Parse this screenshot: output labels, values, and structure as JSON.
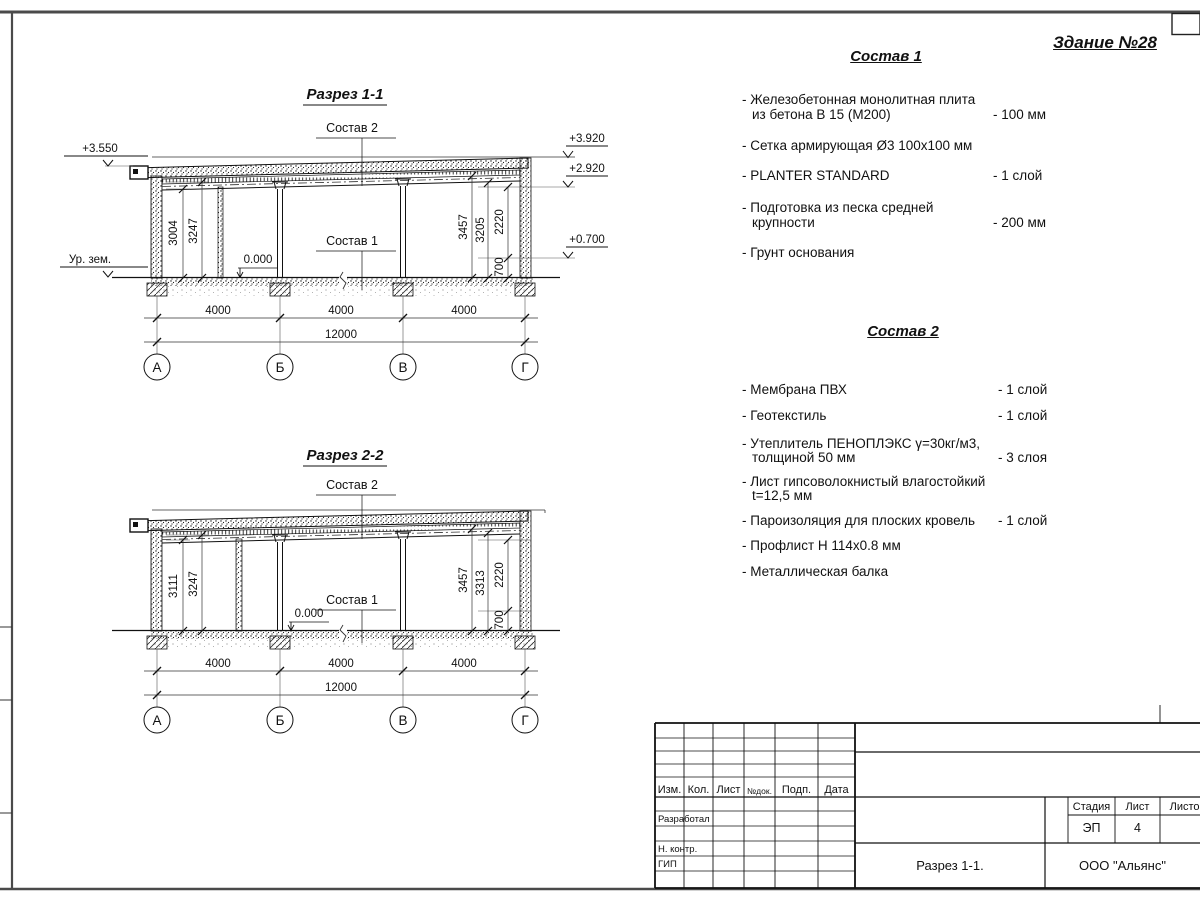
{
  "sheet": {
    "building_title": "Здание №28"
  },
  "grid": {
    "letters": [
      "А",
      "Б",
      "В",
      "Г"
    ]
  },
  "dims": {
    "span": "4000",
    "total": "12000"
  },
  "sec1": {
    "title": "Разрез 1-1",
    "roof_label": "Состав 2",
    "floor_label": "Состав 1",
    "zero": "0.000",
    "elev_left": "+3.550",
    "ground": "Ур. зем.",
    "elev_r1": "+3.920",
    "elev_r2": "+2.920",
    "elev_r3": "+0.700",
    "dl1": "3004",
    "dl2": "3247",
    "dr1": "3457",
    "dr2": "3205",
    "dr3": "2220",
    "dr4": "700"
  },
  "sec2": {
    "title": "Разрез 2-2",
    "roof_label": "Состав 2",
    "floor_label": "Состав 1",
    "zero": "0.000",
    "dl1": "3111",
    "dl2": "3247",
    "dr1": "3457",
    "dr2": "3313",
    "dr3": "2220",
    "dr4": "700"
  },
  "comp1": {
    "title": "Состав 1",
    "items": [
      {
        "l1": "- Железобетонная  монолитная плита",
        "l2": "из бетона В 15 (М200)",
        "value": "- 100 мм"
      },
      {
        "l1": "- Сетка армирующая Ø3 100х100 мм",
        "l2": "",
        "value": ""
      },
      {
        "l1": "- PLANTER STANDARD",
        "l2": "",
        "value": "- 1  слой"
      },
      {
        "l1": "- Подготовка из песка средней",
        "l2": "крупности",
        "value": "- 200 мм"
      },
      {
        "l1": "- Грунт основания",
        "l2": "",
        "value": ""
      }
    ]
  },
  "comp2": {
    "title": "Состав 2",
    "items": [
      {
        "l1": "- Мембрана ПВХ",
        "l2": "",
        "value": "- 1 слой"
      },
      {
        "l1": "- Геотекстиль",
        "l2": "",
        "value": "- 1 слой"
      },
      {
        "l1": "- Утеплитель ПЕНОПЛЭКС γ=30кг/м3,",
        "l2": "толщиной 50 мм",
        "value": "- 3 слоя"
      },
      {
        "l1": "- Лист гипсоволокнистый влагостойкий",
        "l2": "t=12,5 мм",
        "value": ""
      },
      {
        "l1": "- Пароизоляция для плоских кровель",
        "l2": "",
        "value": "- 1 слой"
      },
      {
        "l1": "- Профлист Н 114х0.8 мм",
        "l2": "",
        "value": ""
      },
      {
        "l1": "- Металлическая балка",
        "l2": "",
        "value": ""
      }
    ]
  },
  "tb": {
    "col_izm": "Изм.",
    "col_kol": "Кол.",
    "col_list": "Лист",
    "col_ndok": "№док.",
    "col_podp": "Подп.",
    "col_data": "Дата",
    "row_dev": "Разработал",
    "row_ncontr": "Н. контр.",
    "row_gip": "ГИП",
    "stage_label": "Стадия",
    "sheet_label": "Лист",
    "sheets_label": "Листов",
    "stage_value": "ЭП",
    "sheet_value": "4",
    "doc_name": "Разрез 1-1.",
    "company": "ООО \"Альянс\""
  }
}
